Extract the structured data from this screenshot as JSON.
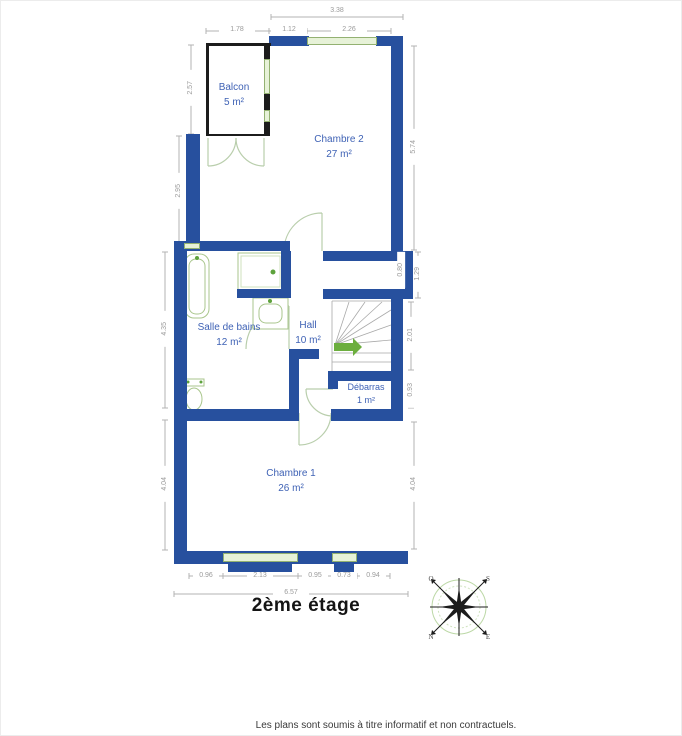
{
  "plan": {
    "title": "2ème étage",
    "footer": "Les plans sont soumis à titre informatif et non contractuels.",
    "rooms": {
      "balcon": {
        "name": "Balcon",
        "area": "5 m²"
      },
      "chambre2": {
        "name": "Chambre 2",
        "area": "27 m²"
      },
      "salle_de_bains": {
        "name": "Salle de bains",
        "area": "12 m²"
      },
      "hall": {
        "name": "Hall",
        "area": "10 m²"
      },
      "debarras": {
        "name": "Débarras",
        "area": "1 m²"
      },
      "chambre1": {
        "name": "Chambre 1",
        "area": "26 m²"
      }
    },
    "dimensions": {
      "top": {
        "overall": "3.38",
        "balcon_width": "1.78",
        "wall_segment": "1.12",
        "window": "2.26"
      },
      "left": {
        "balcon_height": "2.57",
        "upper": "2.95",
        "middle": "4.35",
        "lower": "4.04"
      },
      "right": {
        "chambre2_height": "5.74",
        "recess_inner": "0.80",
        "recess_outer": "1.29",
        "stair": "2.01",
        "debarras": "0.93",
        "chambre1_height": "4.04"
      },
      "bottom": {
        "seg1": "0.96",
        "seg2": "2.13",
        "seg3": "0.95",
        "seg4": "0.73",
        "seg5": "0.94",
        "overall": "6.57"
      }
    },
    "compass": {
      "n": "N",
      "s": "S",
      "e": "E",
      "o": "O"
    },
    "colors": {
      "wall_blue": "#27509e",
      "window_green": "#e7f2d8",
      "fixture_green": "#a9c68c",
      "arrow_green": "#6cae3e"
    }
  }
}
